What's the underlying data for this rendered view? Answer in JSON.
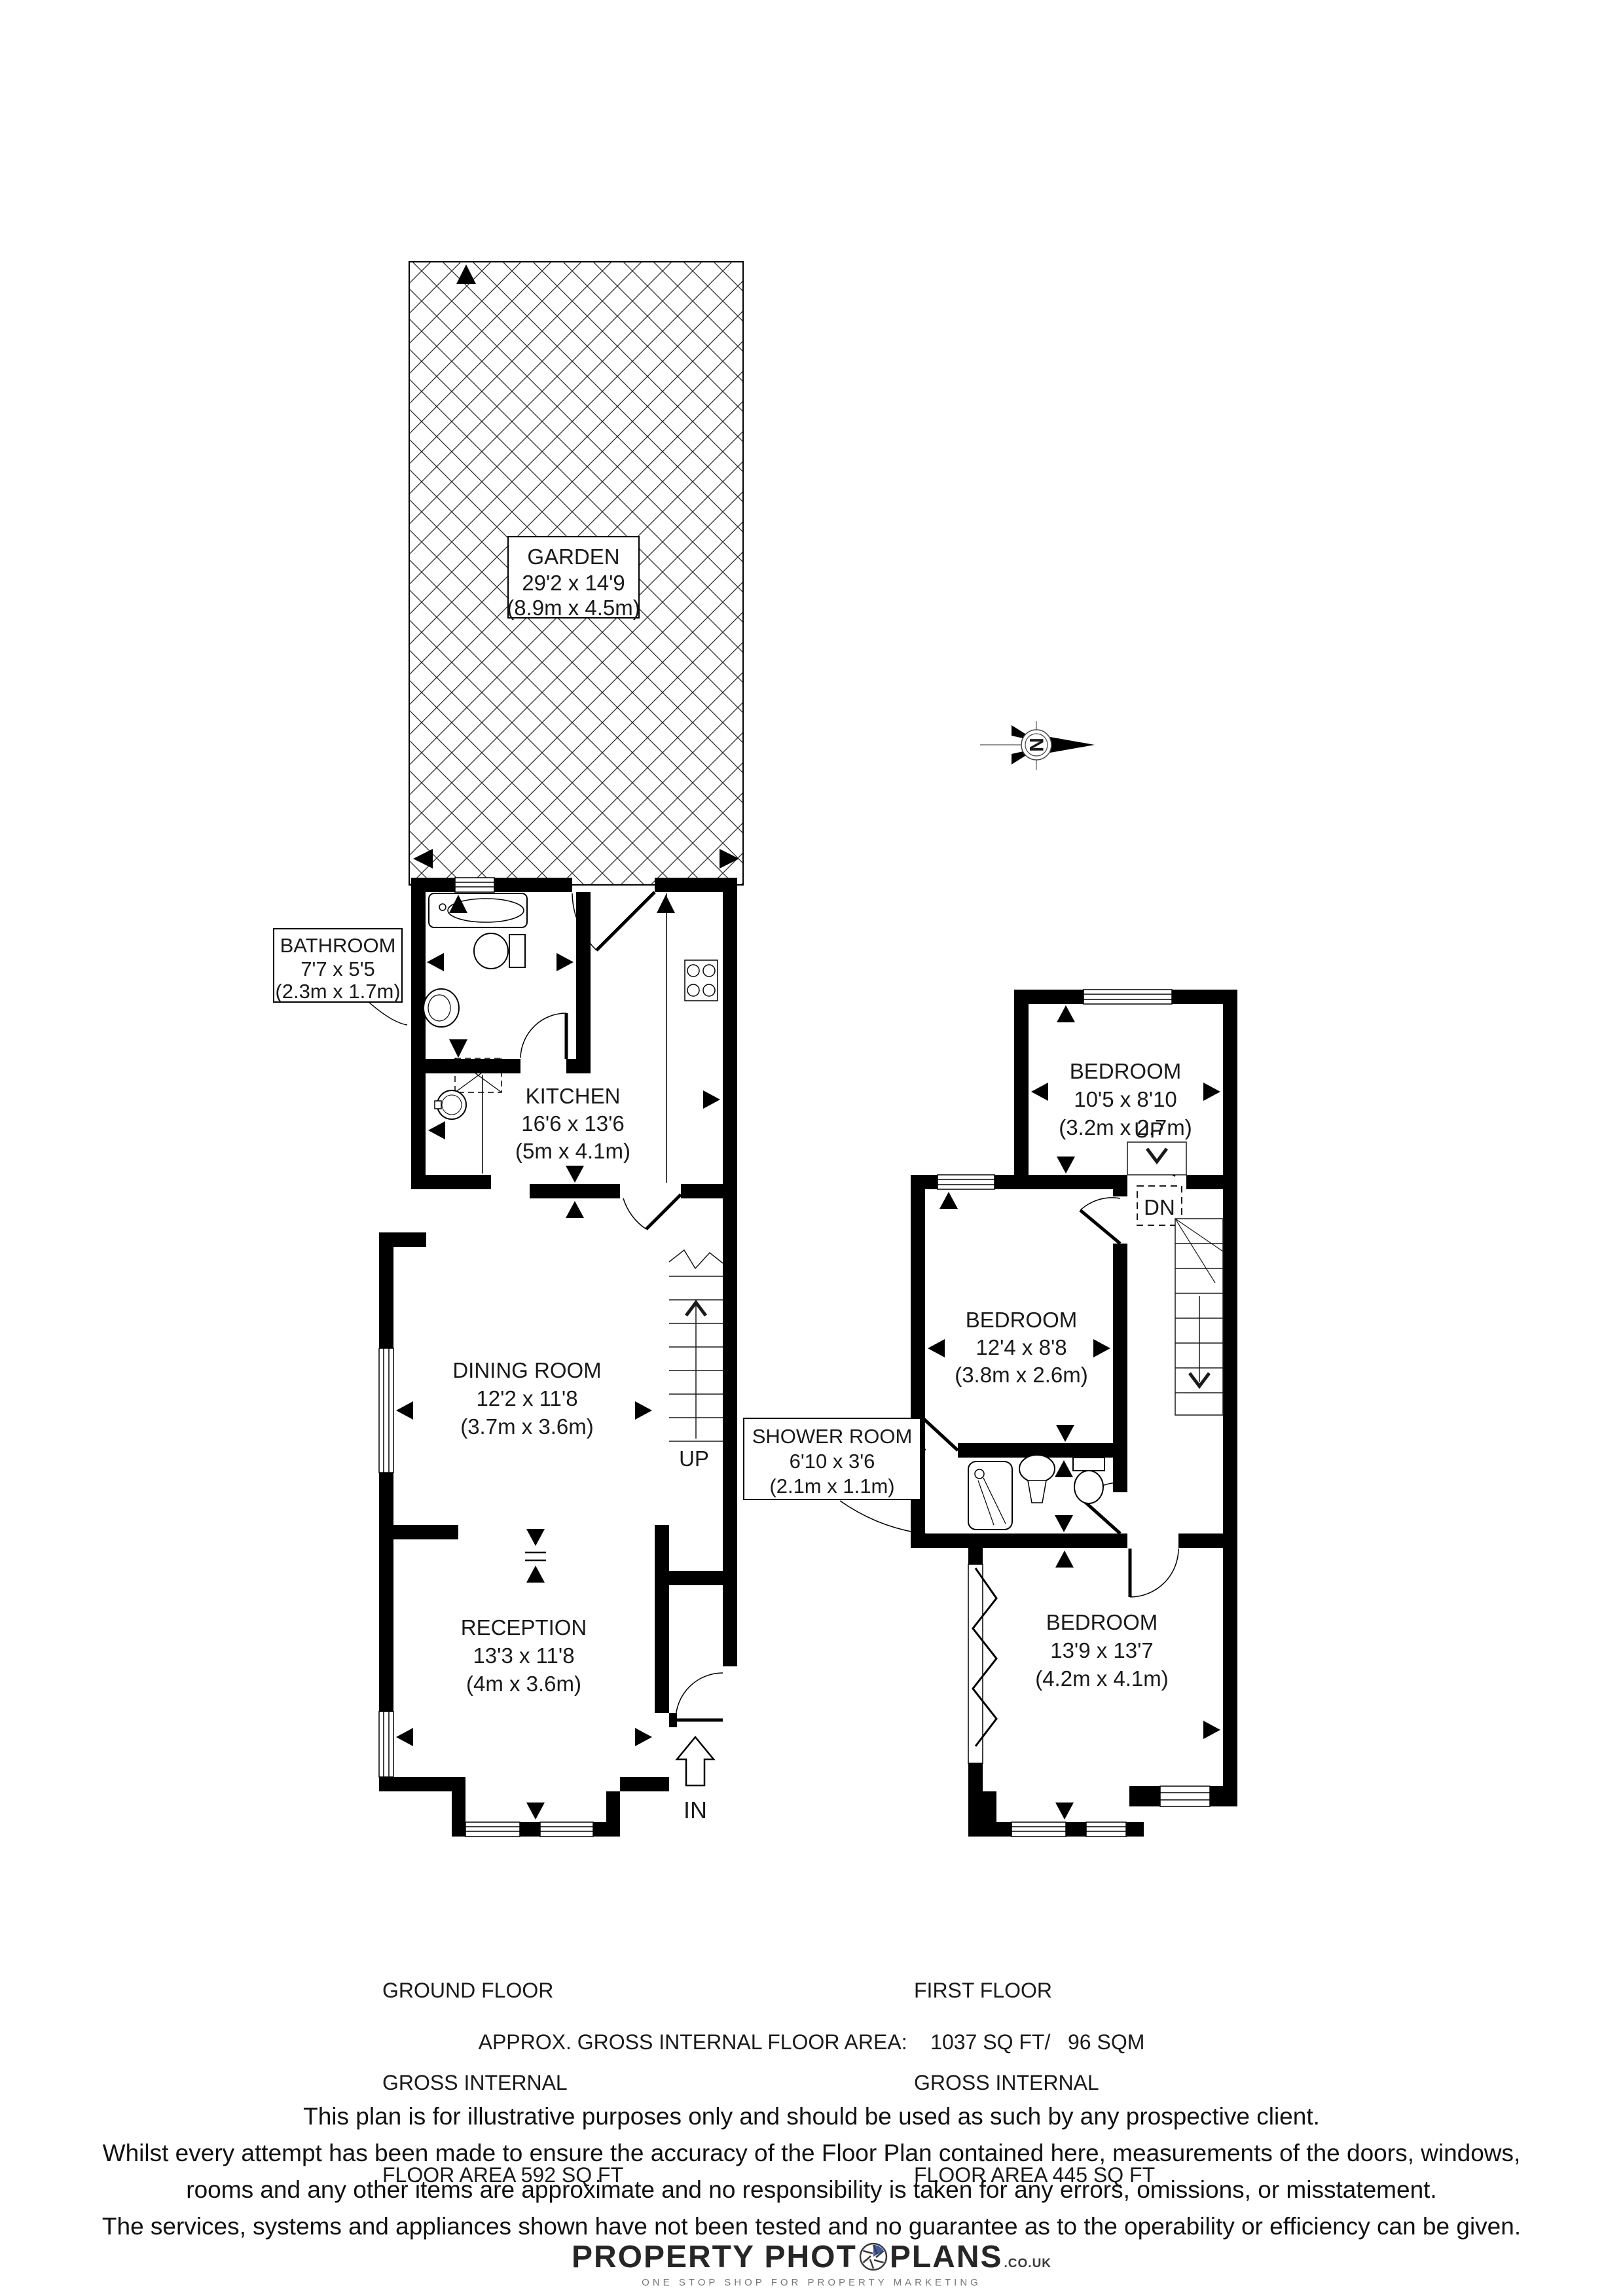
{
  "rooms": {
    "garden": {
      "name": "GARDEN",
      "imperial": "29'2 x 14'9",
      "metric": "(8.9m x 4.5m)"
    },
    "bathroom": {
      "name": "BATHROOM",
      "imperial": "7'7 x 5'5",
      "metric": "(2.3m x 1.7m)"
    },
    "kitchen": {
      "name": "KITCHEN",
      "imperial": "16'6 x 13'6",
      "metric": "(5m x 4.1m)"
    },
    "dining": {
      "name": "DINING ROOM",
      "imperial": "12'2 x 11'8",
      "metric": "(3.7m x 3.6m)"
    },
    "reception": {
      "name": "RECEPTION",
      "imperial": "13'3 x 11'8",
      "metric": "(4m x 3.6m)"
    },
    "bedroom_rear": {
      "name": "BEDROOM",
      "imperial": "10'5 x 8'10",
      "metric": "(3.2m x 2.7m)"
    },
    "bedroom_middle": {
      "name": "BEDROOM",
      "imperial": "12'4 x 8'8",
      "metric": "(3.8m x 2.6m)"
    },
    "shower": {
      "name": "SHOWER ROOM",
      "imperial": "6'10 x 3'6",
      "metric": "(2.1m x 1.1m)"
    },
    "bedroom_front": {
      "name": "BEDROOM",
      "imperial": "13'9 x 13'7",
      "metric": "(4.2m x 4.1m)"
    }
  },
  "labels": {
    "up": "UP",
    "down": "DN",
    "entry": "IN",
    "north": "N"
  },
  "footer": {
    "ground": [
      "GROUND FLOOR",
      "GROSS INTERNAL",
      "FLOOR AREA 592 SQ FT"
    ],
    "first": [
      "FIRST FLOOR",
      "GROSS INTERNAL",
      "FLOOR AREA 445 SQ FT"
    ],
    "approx": "APPROX. GROSS INTERNAL FLOOR AREA:    1037 SQ FT/   96 SQM",
    "disclaimer": [
      "This plan is for illustrative purposes only and should be used as such by any prospective client.",
      "Whilst every attempt has been made to ensure the accuracy of the Floor Plan contained here, measurements of the doors, windows,",
      "rooms and any other items are approximate and no responsibility is taken for any errors, omissions, or misstatement.",
      "The services, systems and appliances shown have not been tested and no guarantee as to the operability or efficiency can be given."
    ]
  },
  "logo": {
    "brand_left": "PROPERTY PHOT",
    "brand_right": "PLANS",
    "domain": ".CO.UK",
    "tagline": "ONE STOP SHOP FOR PROPERTY MARKETING",
    "accent_blue": "#3b5ca8",
    "wall_color": "#000000"
  }
}
